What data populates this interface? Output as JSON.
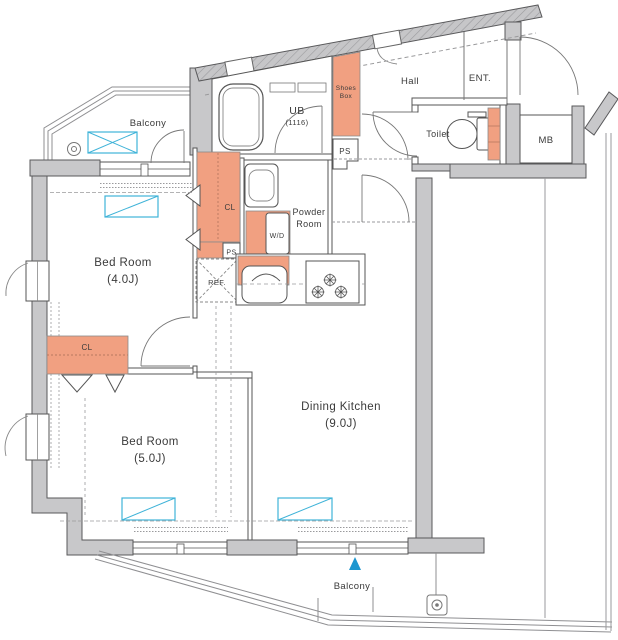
{
  "floor_plan": {
    "rooms": {
      "balcony_top": {
        "label": "Balcony"
      },
      "bed_room_4": {
        "label": "Bed Room",
        "size": "(4.0J)"
      },
      "bed_room_5": {
        "label": "Bed Room",
        "size": "(5.0J)"
      },
      "dining_kitchen": {
        "label": "Dining Kitchen",
        "size": "(9.0J)"
      },
      "powder_room": {
        "label_line1": "Powder",
        "label_line2": "Room"
      },
      "unit_bath": {
        "label": "UB",
        "size": "(1116)"
      },
      "hall": {
        "label": "Hall"
      },
      "entrance": {
        "label": "ENT."
      },
      "toilet": {
        "label": "Toilet"
      },
      "meter_box": {
        "label": "MB"
      },
      "balcony_bottom": {
        "label": "Balcony"
      }
    },
    "fixtures": {
      "shoes_box": {
        "label_line1": "Shoes",
        "label_line2": "Box"
      },
      "pipe_space_hall": {
        "label": "PS"
      },
      "pipe_space_corridor": {
        "label": "PS"
      },
      "closet_corridor": {
        "label": "CL"
      },
      "closet_bed5": {
        "label": "CL"
      },
      "washer_dryer": {
        "label": "W/D"
      },
      "refrigerator": {
        "label": "REF."
      }
    },
    "colors": {
      "wall_gray": "#c8c8ca",
      "storage_orange": "#f1a081",
      "fixture_blue": "#3fb3d8",
      "marker_blue": "#1e97d0"
    }
  }
}
